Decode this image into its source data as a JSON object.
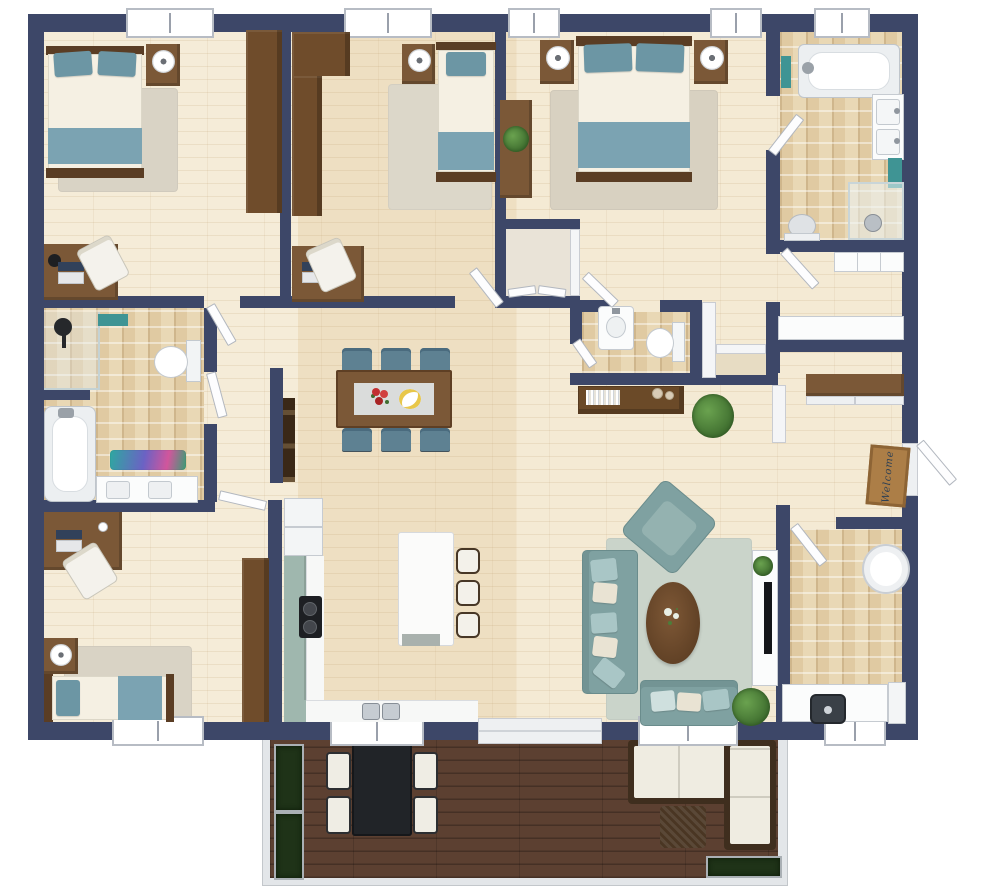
{
  "title": "3D floor plan - single storey home with deck",
  "entry": {
    "welcome_mat_text": "Welcome"
  },
  "palette": {
    "wall_navy": "#3d4768",
    "floor_wood": "#f1e5cd",
    "floor_tile": "#e9d8b5",
    "deck_wood": "#5c4031",
    "furniture_wood": "#7b5837",
    "furniture_wood_dark": "#5e3f26",
    "wardrobe_wood": "#6f4c2b",
    "textile_teal": "#6c96a4",
    "blanket_blue": "#7ba3b2",
    "sofa_teal": "#7fa1a1",
    "pillow_mint": "#a9c6c6",
    "pillow_cream": "#e9e3d3",
    "dining_chair_blue": "#5e8192",
    "cabinet_sage": "#9fb7ae",
    "rug_green": "#cad4ca",
    "rug_beige": "#d9d3c5",
    "towel_teal": "#3f9494",
    "mat_brown": "#ac7e47",
    "plant_green": "#4c7d3a",
    "fixture_white": "#ffffff"
  },
  "rooms": [
    {
      "name": "bedroom-1",
      "position": "top-left",
      "furniture": [
        "double bed with blue pillows and blanket",
        "nightstand with lamp",
        "wardrobe",
        "desk",
        "desk chair",
        "laptop",
        "black desk lamp",
        "rug",
        "window"
      ]
    },
    {
      "name": "bedroom-2",
      "position": "top-middle",
      "furniture": [
        "single bed",
        "nightstand with lamp",
        "L-shaped wardrobe",
        "desk",
        "desk chair",
        "laptop",
        "rug",
        "window"
      ]
    },
    {
      "name": "master-bedroom",
      "position": "top-right",
      "furniture": [
        "double bed",
        "two nightstands with lamps",
        "dresser with flowers",
        "walk-in closet",
        "rug",
        "two windows"
      ]
    },
    {
      "name": "ensuite-bathroom",
      "position": "top-right-corner",
      "furniture": [
        "bathtub",
        "double sink vanity",
        "corner shower",
        "toilet",
        "teal towels",
        "window"
      ]
    },
    {
      "name": "bathroom-2",
      "position": "middle-left",
      "furniture": [
        "walk-in shower",
        "bathtub",
        "toilet",
        "vanity with two sinks",
        "colorful bath mat",
        "teal towel"
      ]
    },
    {
      "name": "powder-room",
      "position": "center",
      "furniture": [
        "sink",
        "toilet"
      ]
    },
    {
      "name": "hallway",
      "position": "center",
      "furniture": [
        "console table with books and vases",
        "potted plant",
        "hall closet",
        "dark wall console"
      ]
    },
    {
      "name": "storage-room",
      "position": "middle-right",
      "furniture": [
        "built-in shelves",
        "counter"
      ]
    },
    {
      "name": "entry",
      "position": "right",
      "furniture": [
        "welcome mat",
        "open front door",
        "sliding-door closet"
      ]
    },
    {
      "name": "laundry-room",
      "position": "bottom-right",
      "furniture": [
        "counter with inset sink",
        "appliance",
        "round laundry basket",
        "window"
      ]
    },
    {
      "name": "kitchen",
      "position": "bottom-center-left",
      "furniture": [
        "fridge",
        "L-shaped sage counter",
        "cooktop",
        "double sink",
        "island",
        "three bar stools",
        "window"
      ]
    },
    {
      "name": "dining-area",
      "position": "center",
      "furniture": [
        "wood dining table",
        "six blue chairs",
        "table runner",
        "red flowers",
        "fruit plate"
      ]
    },
    {
      "name": "living-room",
      "position": "bottom-center-right",
      "furniture": [
        "three-seat sofa",
        "angled armchair",
        "loveseat",
        "oval coffee table",
        "green rug",
        "TV console",
        "TV",
        "potted plants",
        "window"
      ]
    },
    {
      "name": "bedroom-3",
      "position": "bottom-left",
      "furniture": [
        "single bed",
        "nightstand with lamp",
        "corner desk",
        "desk chair",
        "laptop",
        "wardrobe",
        "rug",
        "window"
      ]
    },
    {
      "name": "deck",
      "position": "bottom",
      "furniture": [
        "black outdoor dining table",
        "four outdoor chairs",
        "L-shaped outdoor sectional",
        "wicker ottoman",
        "planter boxes"
      ]
    }
  ]
}
